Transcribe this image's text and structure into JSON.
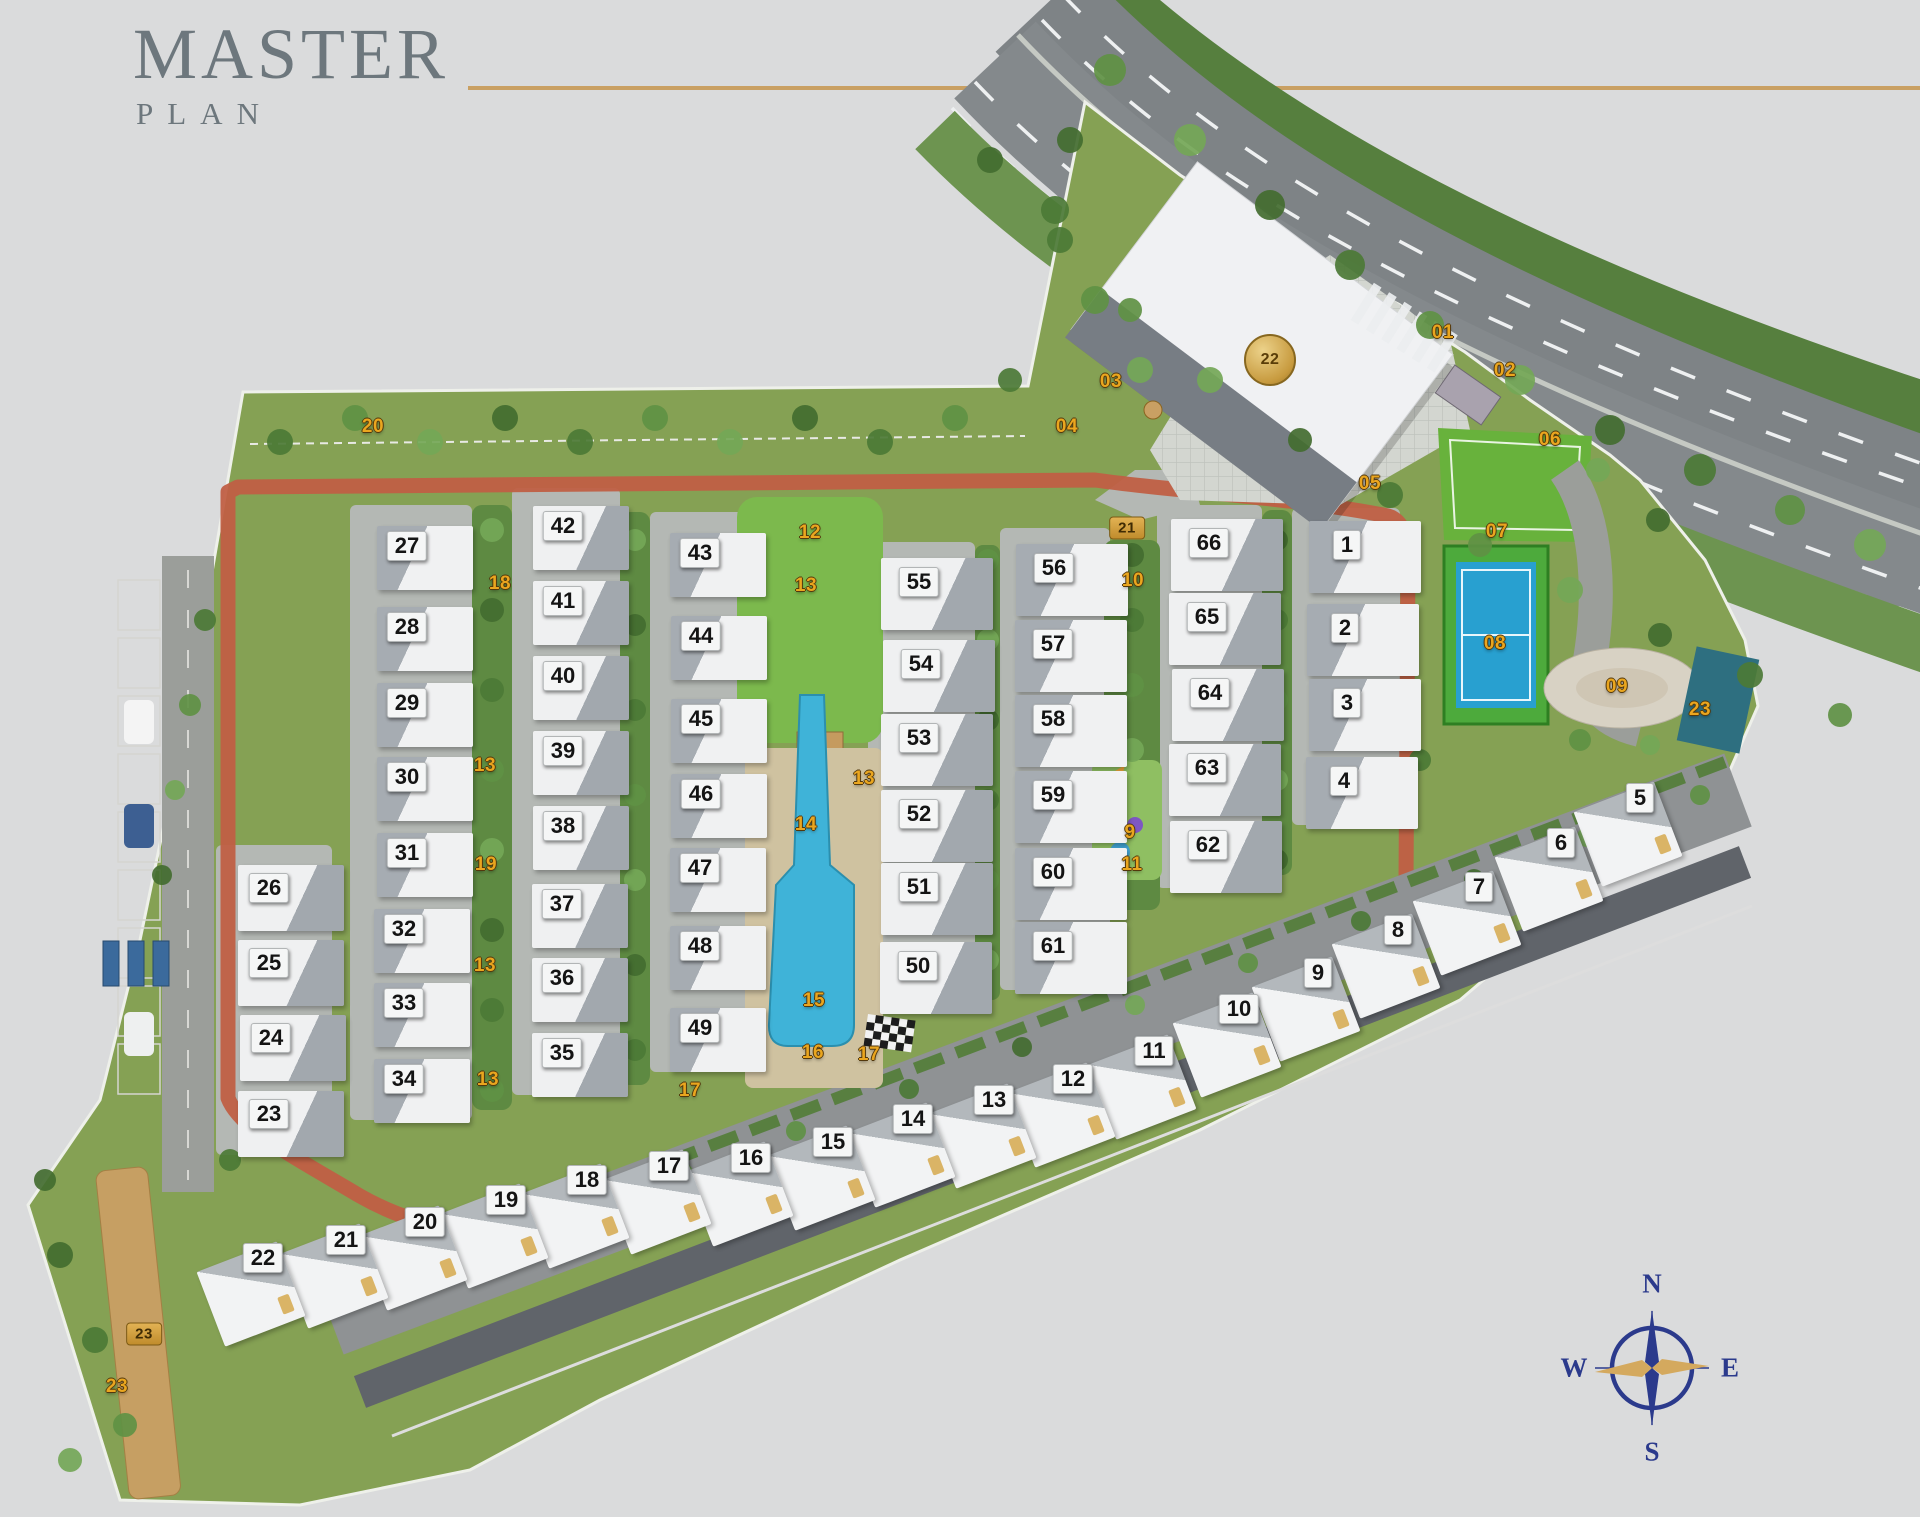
{
  "title": {
    "main": "MASTER",
    "sub": "PLAN"
  },
  "colors": {
    "accent_gold_rule": "#c9a063",
    "marker_gold": "#eaa61f",
    "compass_navy": "#2b3a8c",
    "site_green": "#85a154",
    "internal_road_red": "#c05f45",
    "pool_blue": "#3fb3d8",
    "tennis_blue": "#28a0d0",
    "lawn_green": "#68b23c"
  },
  "compass": {
    "n": "N",
    "s": "S",
    "e": "E",
    "w": "W"
  },
  "villas_grid": [
    [
      27,
      407,
      546
    ],
    [
      28,
      407,
      627
    ],
    [
      29,
      407,
      703
    ],
    [
      30,
      407,
      777
    ],
    [
      31,
      407,
      853
    ],
    [
      32,
      404,
      929
    ],
    [
      33,
      404,
      1003
    ],
    [
      34,
      404,
      1079
    ],
    [
      26,
      269,
      888
    ],
    [
      25,
      269,
      963
    ],
    [
      24,
      271,
      1038
    ],
    [
      23,
      269,
      1114
    ],
    [
      42,
      563,
      526
    ],
    [
      41,
      563,
      601
    ],
    [
      40,
      563,
      676
    ],
    [
      39,
      563,
      751
    ],
    [
      38,
      563,
      826
    ],
    [
      37,
      562,
      904
    ],
    [
      36,
      562,
      978
    ],
    [
      35,
      562,
      1053
    ],
    [
      43,
      700,
      553
    ],
    [
      44,
      701,
      636
    ],
    [
      45,
      701,
      719
    ],
    [
      46,
      701,
      794
    ],
    [
      47,
      700,
      868
    ],
    [
      48,
      700,
      946
    ],
    [
      49,
      700,
      1028
    ],
    [
      55,
      919,
      582
    ],
    [
      54,
      921,
      664
    ],
    [
      53,
      919,
      738
    ],
    [
      52,
      919,
      814
    ],
    [
      51,
      919,
      887
    ],
    [
      50,
      918,
      966
    ],
    [
      56,
      1054,
      568
    ],
    [
      57,
      1053,
      644
    ],
    [
      58,
      1053,
      719
    ],
    [
      59,
      1053,
      795
    ],
    [
      60,
      1053,
      872
    ],
    [
      61,
      1053,
      946
    ],
    [
      66,
      1209,
      543
    ],
    [
      65,
      1207,
      617
    ],
    [
      64,
      1210,
      693
    ],
    [
      63,
      1207,
      768
    ],
    [
      62,
      1208,
      845
    ],
    [
      1,
      1347,
      545
    ],
    [
      2,
      1345,
      628
    ],
    [
      3,
      1347,
      703
    ],
    [
      4,
      1344,
      781
    ]
  ],
  "villas_row": [
    [
      5,
      1640,
      798
    ],
    [
      6,
      1561,
      843
    ],
    [
      7,
      1479,
      887
    ],
    [
      8,
      1398,
      930
    ],
    [
      9,
      1318,
      973
    ],
    [
      10,
      1239,
      1009
    ],
    [
      11,
      1154,
      1051
    ],
    [
      12,
      1073,
      1079
    ],
    [
      13,
      994,
      1100
    ],
    [
      14,
      913,
      1119
    ],
    [
      15,
      833,
      1142
    ],
    [
      16,
      751,
      1158
    ],
    [
      17,
      669,
      1166
    ],
    [
      18,
      587,
      1180
    ],
    [
      19,
      506,
      1200
    ],
    [
      20,
      425,
      1222
    ],
    [
      21,
      346,
      1240
    ],
    [
      22,
      263,
      1258
    ]
  ],
  "amenity_markers": [
    [
      "01",
      1443,
      333,
      "text"
    ],
    [
      "02",
      1505,
      371,
      "text"
    ],
    [
      "03",
      1111,
      382,
      "text"
    ],
    [
      "04",
      1067,
      427,
      "text"
    ],
    [
      "05",
      1370,
      484,
      "text"
    ],
    [
      "06",
      1550,
      440,
      "text"
    ],
    [
      "07",
      1497,
      532,
      "text"
    ],
    [
      "08",
      1495,
      644,
      "text"
    ],
    [
      "09",
      1617,
      687,
      "text"
    ],
    [
      "10",
      1133,
      581,
      "text"
    ],
    [
      "21",
      1127,
      528,
      "box"
    ],
    [
      "22",
      1270,
      360,
      "badge"
    ],
    [
      "9",
      1130,
      833,
      "text"
    ],
    [
      "11",
      1132,
      865,
      "text"
    ],
    [
      "12",
      810,
      533,
      "text"
    ],
    [
      "13",
      806,
      586,
      "text"
    ],
    [
      "13",
      864,
      779,
      "text"
    ],
    [
      "13",
      485,
      766,
      "text"
    ],
    [
      "13",
      485,
      966,
      "text"
    ],
    [
      "13",
      488,
      1080,
      "text"
    ],
    [
      "14",
      806,
      825,
      "text"
    ],
    [
      "15",
      814,
      1001,
      "text"
    ],
    [
      "16",
      813,
      1053,
      "text"
    ],
    [
      "17",
      869,
      1055,
      "text"
    ],
    [
      "17",
      690,
      1091,
      "text"
    ],
    [
      "18",
      500,
      584,
      "text"
    ],
    [
      "19",
      486,
      865,
      "text"
    ],
    [
      "20",
      373,
      427,
      "text"
    ],
    [
      "23",
      1700,
      710,
      "text"
    ],
    [
      "23",
      144,
      1334,
      "box"
    ],
    [
      "23",
      117,
      1387,
      "text"
    ]
  ]
}
